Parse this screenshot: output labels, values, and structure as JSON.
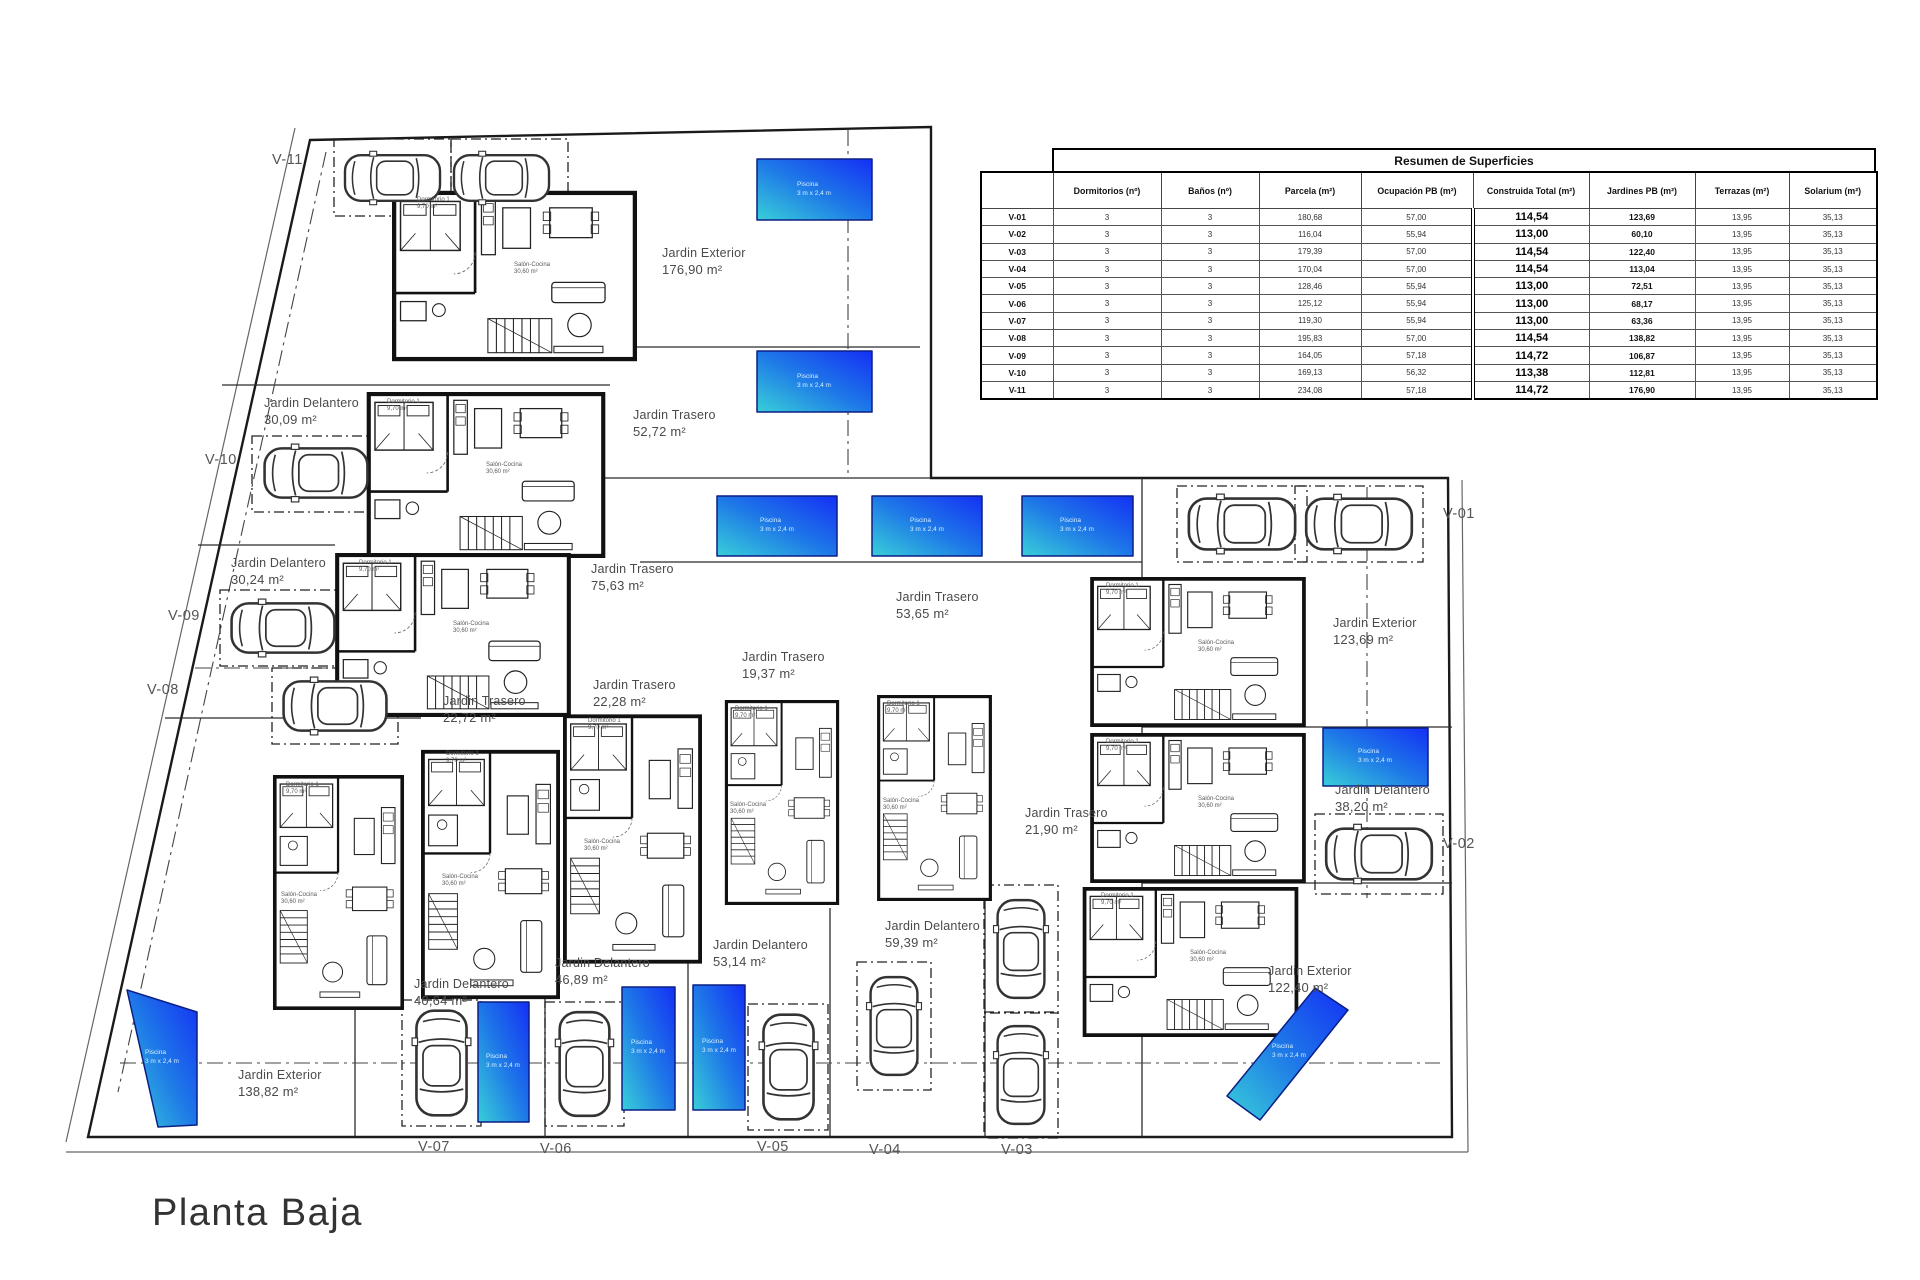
{
  "title": "Planta Baja",
  "table": {
    "title": "Resumen de Superficies",
    "headers": [
      "",
      "Dormitorios (nº)",
      "Baños (nº)",
      "Parcela (m²)",
      "Ocupación PB (m²)",
      "Construida Total (m²)",
      "Jardines PB (m²)",
      "Terrazas (m²)",
      "Solarium (m²)"
    ],
    "rows": [
      {
        "id": "V-01",
        "dorm": "3",
        "banos": "3",
        "parcela": "180,68",
        "ocupacion": "57,00",
        "construida": "114,54",
        "jardines": "123,69",
        "terrazas": "13,95",
        "solarium": "35,13"
      },
      {
        "id": "V-02",
        "dorm": "3",
        "banos": "3",
        "parcela": "116,04",
        "ocupacion": "55,94",
        "construida": "113,00",
        "jardines": "60,10",
        "terrazas": "13,95",
        "solarium": "35,13"
      },
      {
        "id": "V-03",
        "dorm": "3",
        "banos": "3",
        "parcela": "179,39",
        "ocupacion": "57,00",
        "construida": "114,54",
        "jardines": "122,40",
        "terrazas": "13,95",
        "solarium": "35,13"
      },
      {
        "id": "V-04",
        "dorm": "3",
        "banos": "3",
        "parcela": "170,04",
        "ocupacion": "57,00",
        "construida": "114,54",
        "jardines": "113,04",
        "terrazas": "13,95",
        "solarium": "35,13"
      },
      {
        "id": "V-05",
        "dorm": "3",
        "banos": "3",
        "parcela": "128,46",
        "ocupacion": "55,94",
        "construida": "113,00",
        "jardines": "72,51",
        "terrazas": "13,95",
        "solarium": "35,13"
      },
      {
        "id": "V-06",
        "dorm": "3",
        "banos": "3",
        "parcela": "125,12",
        "ocupacion": "55,94",
        "construida": "113,00",
        "jardines": "68,17",
        "terrazas": "13,95",
        "solarium": "35,13"
      },
      {
        "id": "V-07",
        "dorm": "3",
        "banos": "3",
        "parcela": "119,30",
        "ocupacion": "55,94",
        "construida": "113,00",
        "jardines": "63,36",
        "terrazas": "13,95",
        "solarium": "35,13"
      },
      {
        "id": "V-08",
        "dorm": "3",
        "banos": "3",
        "parcela": "195,83",
        "ocupacion": "57,00",
        "construida": "114,54",
        "jardines": "138,82",
        "terrazas": "13,95",
        "solarium": "35,13"
      },
      {
        "id": "V-09",
        "dorm": "3",
        "banos": "3",
        "parcela": "164,05",
        "ocupacion": "57,18",
        "construida": "114,72",
        "jardines": "106,87",
        "terrazas": "13,95",
        "solarium": "35,13"
      },
      {
        "id": "V-10",
        "dorm": "3",
        "banos": "3",
        "parcela": "169,13",
        "ocupacion": "56,32",
        "construida": "113,38",
        "jardines": "112,81",
        "terrazas": "13,95",
        "solarium": "35,13"
      },
      {
        "id": "V-11",
        "dorm": "3",
        "banos": "3",
        "parcela": "234,08",
        "ocupacion": "57,18",
        "construida": "114,72",
        "jardines": "176,90",
        "terrazas": "13,95",
        "solarium": "35,13"
      }
    ]
  },
  "plan": {
    "villa_markers": [
      {
        "id": "V-11",
        "x": 272,
        "y": 152
      },
      {
        "id": "V-10",
        "x": 205,
        "y": 452
      },
      {
        "id": "V-09",
        "x": 168,
        "y": 608
      },
      {
        "id": "V-08",
        "x": 147,
        "y": 682
      },
      {
        "id": "V-07",
        "x": 418,
        "y": 1139
      },
      {
        "id": "V-06",
        "x": 540,
        "y": 1141
      },
      {
        "id": "V-05",
        "x": 757,
        "y": 1139
      },
      {
        "id": "V-04",
        "x": 869,
        "y": 1142
      },
      {
        "id": "V-03",
        "x": 1001,
        "y": 1142
      },
      {
        "id": "V-02",
        "x": 1443,
        "y": 836
      },
      {
        "id": "V-01",
        "x": 1443,
        "y": 506
      }
    ],
    "gardens": [
      {
        "name": "Jardin Exterior",
        "area": "176,90 m²",
        "x": 662,
        "y": 246
      },
      {
        "name": "Jardin Delantero",
        "area": "30,09 m²",
        "x": 264,
        "y": 396
      },
      {
        "name": "Jardin Trasero",
        "area": "52,72 m²",
        "x": 633,
        "y": 408
      },
      {
        "name": "Jardin Delantero",
        "area": "30,24 m²",
        "x": 231,
        "y": 556
      },
      {
        "name": "Jardin Trasero",
        "area": "75,63 m²",
        "x": 591,
        "y": 562
      },
      {
        "name": "Jardin Trasero",
        "area": "53,65 m²",
        "x": 896,
        "y": 590
      },
      {
        "name": "Jardin Exterior",
        "area": "123,69 m²",
        "x": 1333,
        "y": 616
      },
      {
        "name": "Jardin Trasero",
        "area": "22,28 m²",
        "x": 593,
        "y": 678
      },
      {
        "name": "Jardin Trasero",
        "area": "22,72 m²",
        "x": 443,
        "y": 694
      },
      {
        "name": "Jardin Trasero",
        "area": "19,37 m²",
        "x": 742,
        "y": 650
      },
      {
        "name": "Jardin Trasero",
        "area": "21,90 m²",
        "x": 1025,
        "y": 806
      },
      {
        "name": "Jardin Delantero",
        "area": "38,20 m²",
        "x": 1335,
        "y": 783
      },
      {
        "name": "Jardin Delantero",
        "area": "40,64 m²",
        "x": 414,
        "y": 977
      },
      {
        "name": "Jardin Delantero",
        "area": "46,89 m²",
        "x": 555,
        "y": 956
      },
      {
        "name": "Jardin Delantero",
        "area": "53,14 m²",
        "x": 713,
        "y": 938
      },
      {
        "name": "Jardin Delantero",
        "area": "59,39 m²",
        "x": 885,
        "y": 919
      },
      {
        "name": "Jardin Exterior",
        "area": "138,82 m²",
        "x": 238,
        "y": 1068
      },
      {
        "name": "Jardin Exterior",
        "area": "122,40 m²",
        "x": 1268,
        "y": 964
      }
    ],
    "pool_labels": [
      {
        "x": 814,
        "y": 190,
        "l1": "Piscina",
        "l2": "3 m x 2,4 m"
      },
      {
        "x": 814,
        "y": 382,
        "l1": "Piscina",
        "l2": "3 m x 2,4 m"
      },
      {
        "x": 777,
        "y": 526,
        "l1": "Piscina",
        "l2": "3 m x 2,4 m"
      },
      {
        "x": 927,
        "y": 526,
        "l1": "Piscina",
        "l2": "3 m x 2,4 m"
      },
      {
        "x": 1077,
        "y": 526,
        "l1": "Piscina",
        "l2": "3 m x 2,4 m"
      },
      {
        "x": 1375,
        "y": 757,
        "l1": "Piscina",
        "l2": "3 m x 2,4 m"
      },
      {
        "x": 503,
        "y": 1062,
        "l1": "Piscina",
        "l2": "3 m x 2,4 m"
      },
      {
        "x": 648,
        "y": 1048,
        "l1": "Piscina",
        "l2": "3 m x 2,4 m"
      },
      {
        "x": 719,
        "y": 1047,
        "l1": "Piscina",
        "l2": "3 m x 2,4 m"
      },
      {
        "x": 162,
        "y": 1058,
        "l1": "Piscina",
        "l2": "3 m x 2,4 m"
      },
      {
        "x": 1289,
        "y": 1052,
        "l1": "Piscina",
        "l2": "3 m x 2,4 m"
      }
    ],
    "rooms": [
      {
        "x": 417,
        "y": 197,
        "name": "Dormitorio 1",
        "area": "9,70 m²"
      },
      {
        "x": 387,
        "y": 399,
        "name": "Dormitorio 1",
        "area": "9,70 m²"
      },
      {
        "x": 359,
        "y": 560,
        "name": "Dormitorio 1",
        "area": "9,70 m²"
      },
      {
        "x": 1106,
        "y": 583,
        "name": "Dormitorio 1",
        "area": "9,70 m²"
      },
      {
        "x": 1106,
        "y": 739,
        "name": "Dormitorio 1",
        "area": "9,70 m²"
      },
      {
        "x": 1101,
        "y": 893,
        "name": "Dormitorio 1",
        "area": "9,70 m²"
      },
      {
        "x": 286,
        "y": 782,
        "name": "Dormitorio 1",
        "area": "9,70 m²"
      },
      {
        "x": 446,
        "y": 751,
        "name": "Dormitorio 1",
        "area": "9,70 m²"
      },
      {
        "x": 588,
        "y": 718,
        "name": "Dormitorio 1",
        "area": "9,70 m²"
      },
      {
        "x": 735,
        "y": 706,
        "name": "Dormitorio 1",
        "area": "9,70 m²"
      },
      {
        "x": 887,
        "y": 701,
        "name": "Dormitorio 1",
        "area": "9,70 m²"
      },
      {
        "x": 514,
        "y": 262,
        "name": "Salón-Cocina",
        "area": "30,60 m²"
      },
      {
        "x": 486,
        "y": 462,
        "name": "Salón-Cocina",
        "area": "30,60 m²"
      },
      {
        "x": 453,
        "y": 621,
        "name": "Salón-Cocina",
        "area": "30,60 m²"
      },
      {
        "x": 1198,
        "y": 640,
        "name": "Salón-Cocina",
        "area": "30,60 m²"
      },
      {
        "x": 1198,
        "y": 796,
        "name": "Salón-Cocina",
        "area": "30,60 m²"
      },
      {
        "x": 1190,
        "y": 950,
        "name": "Salón-Cocina",
        "area": "30,60 m²"
      },
      {
        "x": 281,
        "y": 892,
        "name": "Salón-Cocina",
        "area": "30,60 m²"
      },
      {
        "x": 442,
        "y": 874,
        "name": "Salón-Cocina",
        "area": "30,60 m²"
      },
      {
        "x": 584,
        "y": 839,
        "name": "Salón-Cocina",
        "area": "30,60 m²"
      },
      {
        "x": 730,
        "y": 802,
        "name": "Salón-Cocina",
        "area": "30,60 m²"
      },
      {
        "x": 883,
        "y": 798,
        "name": "Salón-Cocina",
        "area": "30,60 m²"
      }
    ]
  }
}
